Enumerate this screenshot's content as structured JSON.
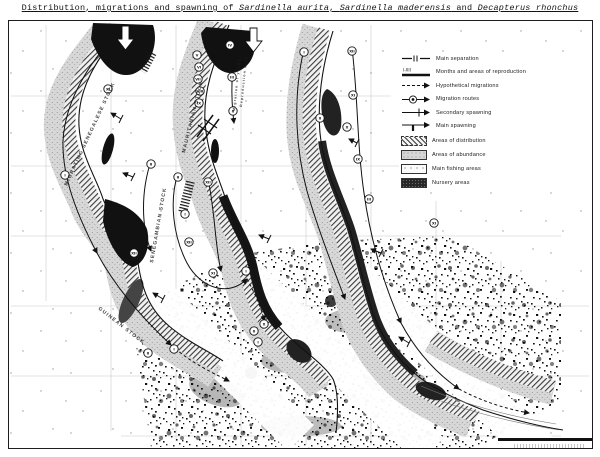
{
  "title": {
    "prefix": "Distribution, migrations and spawning of ",
    "species_1": "Sardinella aurita",
    "sep_1": ", ",
    "species_2": "Sardinella maderensis",
    "sep_2": " and ",
    "species_3": "Decapterus rhonchus"
  },
  "legend": {
    "items": [
      {
        "id": "main-separation",
        "label": "Main separation"
      },
      {
        "id": "months-reproduction",
        "symbol_text": "I-XII",
        "label": "Months and areas of reproduction"
      },
      {
        "id": "hypothetical-migrations",
        "label": "Hypothetical migrations"
      },
      {
        "id": "migration-routes",
        "label": "Migration routes"
      },
      {
        "id": "secondary-spawning",
        "label": "Secondary spawning"
      },
      {
        "id": "main-spawning",
        "label": "Main spawning"
      },
      {
        "id": "areas-distribution",
        "label": "Areas of distribution"
      },
      {
        "id": "areas-abundance",
        "label": "Areas of abundance"
      },
      {
        "id": "main-fishing-areas",
        "label": "Main fishing areas"
      },
      {
        "id": "nursery-areas",
        "label": "Nursery areas"
      }
    ]
  },
  "map": {
    "stock_labels": [
      {
        "text": "MIGRATING SENEGALESE STOCK",
        "x": 66,
        "y": 185,
        "rotate": -65,
        "size": 5
      },
      {
        "text": "MAURITANIAN STOCK",
        "x": 184,
        "y": 152,
        "rotate": -76,
        "size": 5
      },
      {
        "text": "SENEGAMBIAN STOCK",
        "x": 152,
        "y": 262,
        "rotate": -80,
        "size": 5
      },
      {
        "text": "GUINEAN STOCK",
        "x": 97,
        "y": 308,
        "rotate": 38,
        "size": 5
      },
      {
        "text": "Migration of young",
        "x": 234,
        "y": 110,
        "rotate": -84,
        "size": 3.5
      },
      {
        "text": "Reproduction area",
        "x": 241,
        "y": 106,
        "rotate": -84,
        "size": 3.5
      }
    ],
    "month_markers": [
      {
        "label": "XI",
        "x": 107,
        "y": 88
      },
      {
        "label": "I",
        "x": 64,
        "y": 174
      },
      {
        "label": "II",
        "x": 150,
        "y": 163
      },
      {
        "label": "XII",
        "x": 133,
        "y": 252
      },
      {
        "label": "I",
        "x": 173,
        "y": 348
      },
      {
        "label": "II",
        "x": 147,
        "y": 352
      },
      {
        "label": "V",
        "x": 196,
        "y": 54
      },
      {
        "label": "VI",
        "x": 198,
        "y": 66
      },
      {
        "label": "VII",
        "x": 197,
        "y": 78
      },
      {
        "label": "VIII",
        "x": 199,
        "y": 90
      },
      {
        "label": "IX",
        "x": 198,
        "y": 102
      },
      {
        "label": "IV",
        "x": 229,
        "y": 44
      },
      {
        "label": "III",
        "x": 231,
        "y": 76
      },
      {
        "label": "II",
        "x": 232,
        "y": 110
      },
      {
        "label": "II",
        "x": 177,
        "y": 176
      },
      {
        "label": "XII",
        "x": 207,
        "y": 181
      },
      {
        "label": "I",
        "x": 184,
        "y": 213
      },
      {
        "label": "XII",
        "x": 188,
        "y": 241
      },
      {
        "label": "XI",
        "x": 212,
        "y": 272
      },
      {
        "label": "I",
        "x": 245,
        "y": 270
      },
      {
        "label": "I",
        "x": 303,
        "y": 51
      },
      {
        "label": "XII",
        "x": 351,
        "y": 50
      },
      {
        "label": "XI",
        "x": 352,
        "y": 94
      },
      {
        "label": "II",
        "x": 319,
        "y": 117
      },
      {
        "label": "X",
        "x": 346,
        "y": 126
      },
      {
        "label": "IX",
        "x": 357,
        "y": 158
      },
      {
        "label": "III",
        "x": 368,
        "y": 198
      },
      {
        "label": "XI",
        "x": 433,
        "y": 222
      },
      {
        "label": "X",
        "x": 263,
        "y": 323
      },
      {
        "label": "II",
        "x": 253,
        "y": 330
      },
      {
        "label": "I",
        "x": 257,
        "y": 341
      }
    ]
  },
  "colors": {
    "ink": "#1a1a1a",
    "gray_band": "#d4d4d4",
    "paper": "#ffffff"
  }
}
